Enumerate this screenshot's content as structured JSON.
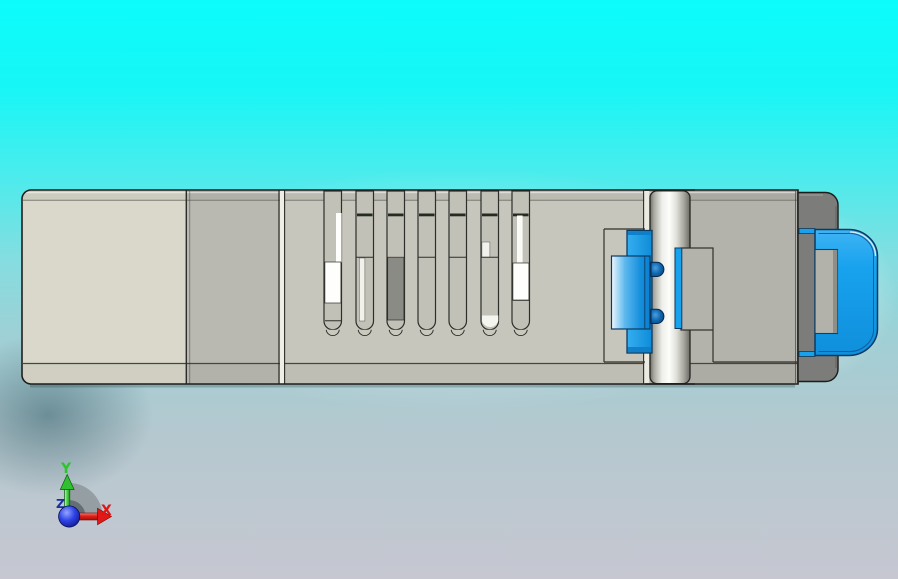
{
  "viewport": {
    "background_top_color": "#0cfcfc",
    "background_bottom_color": "#c6c7d1"
  },
  "model": {
    "contact_slot_count": 7,
    "colors": {
      "panel_left": "#d9d8ca",
      "panel_mid": "#bab9b1",
      "slot_region": "#c7c6bc",
      "panel_right": "#b4b3ab",
      "slot_interior": "#c2c1b7",
      "contact_dark": "#8b8b85",
      "contact_white": "#fefefc",
      "end_cap": "#7c7c7a",
      "latch_blue": "#18a2ee",
      "latch_outline": "#0a3a62",
      "body_outline": "#1f1f1d",
      "cylinder_core": "#fdfdfb"
    }
  },
  "triad": {
    "x_label": "X",
    "y_label": "Y",
    "z_label": "Z",
    "x_color": "#e01616",
    "y_color": "#2bc62b",
    "z_color": "#1a2f9e",
    "origin_color": "#1a2fd0",
    "sector_color": "#8e989c"
  }
}
